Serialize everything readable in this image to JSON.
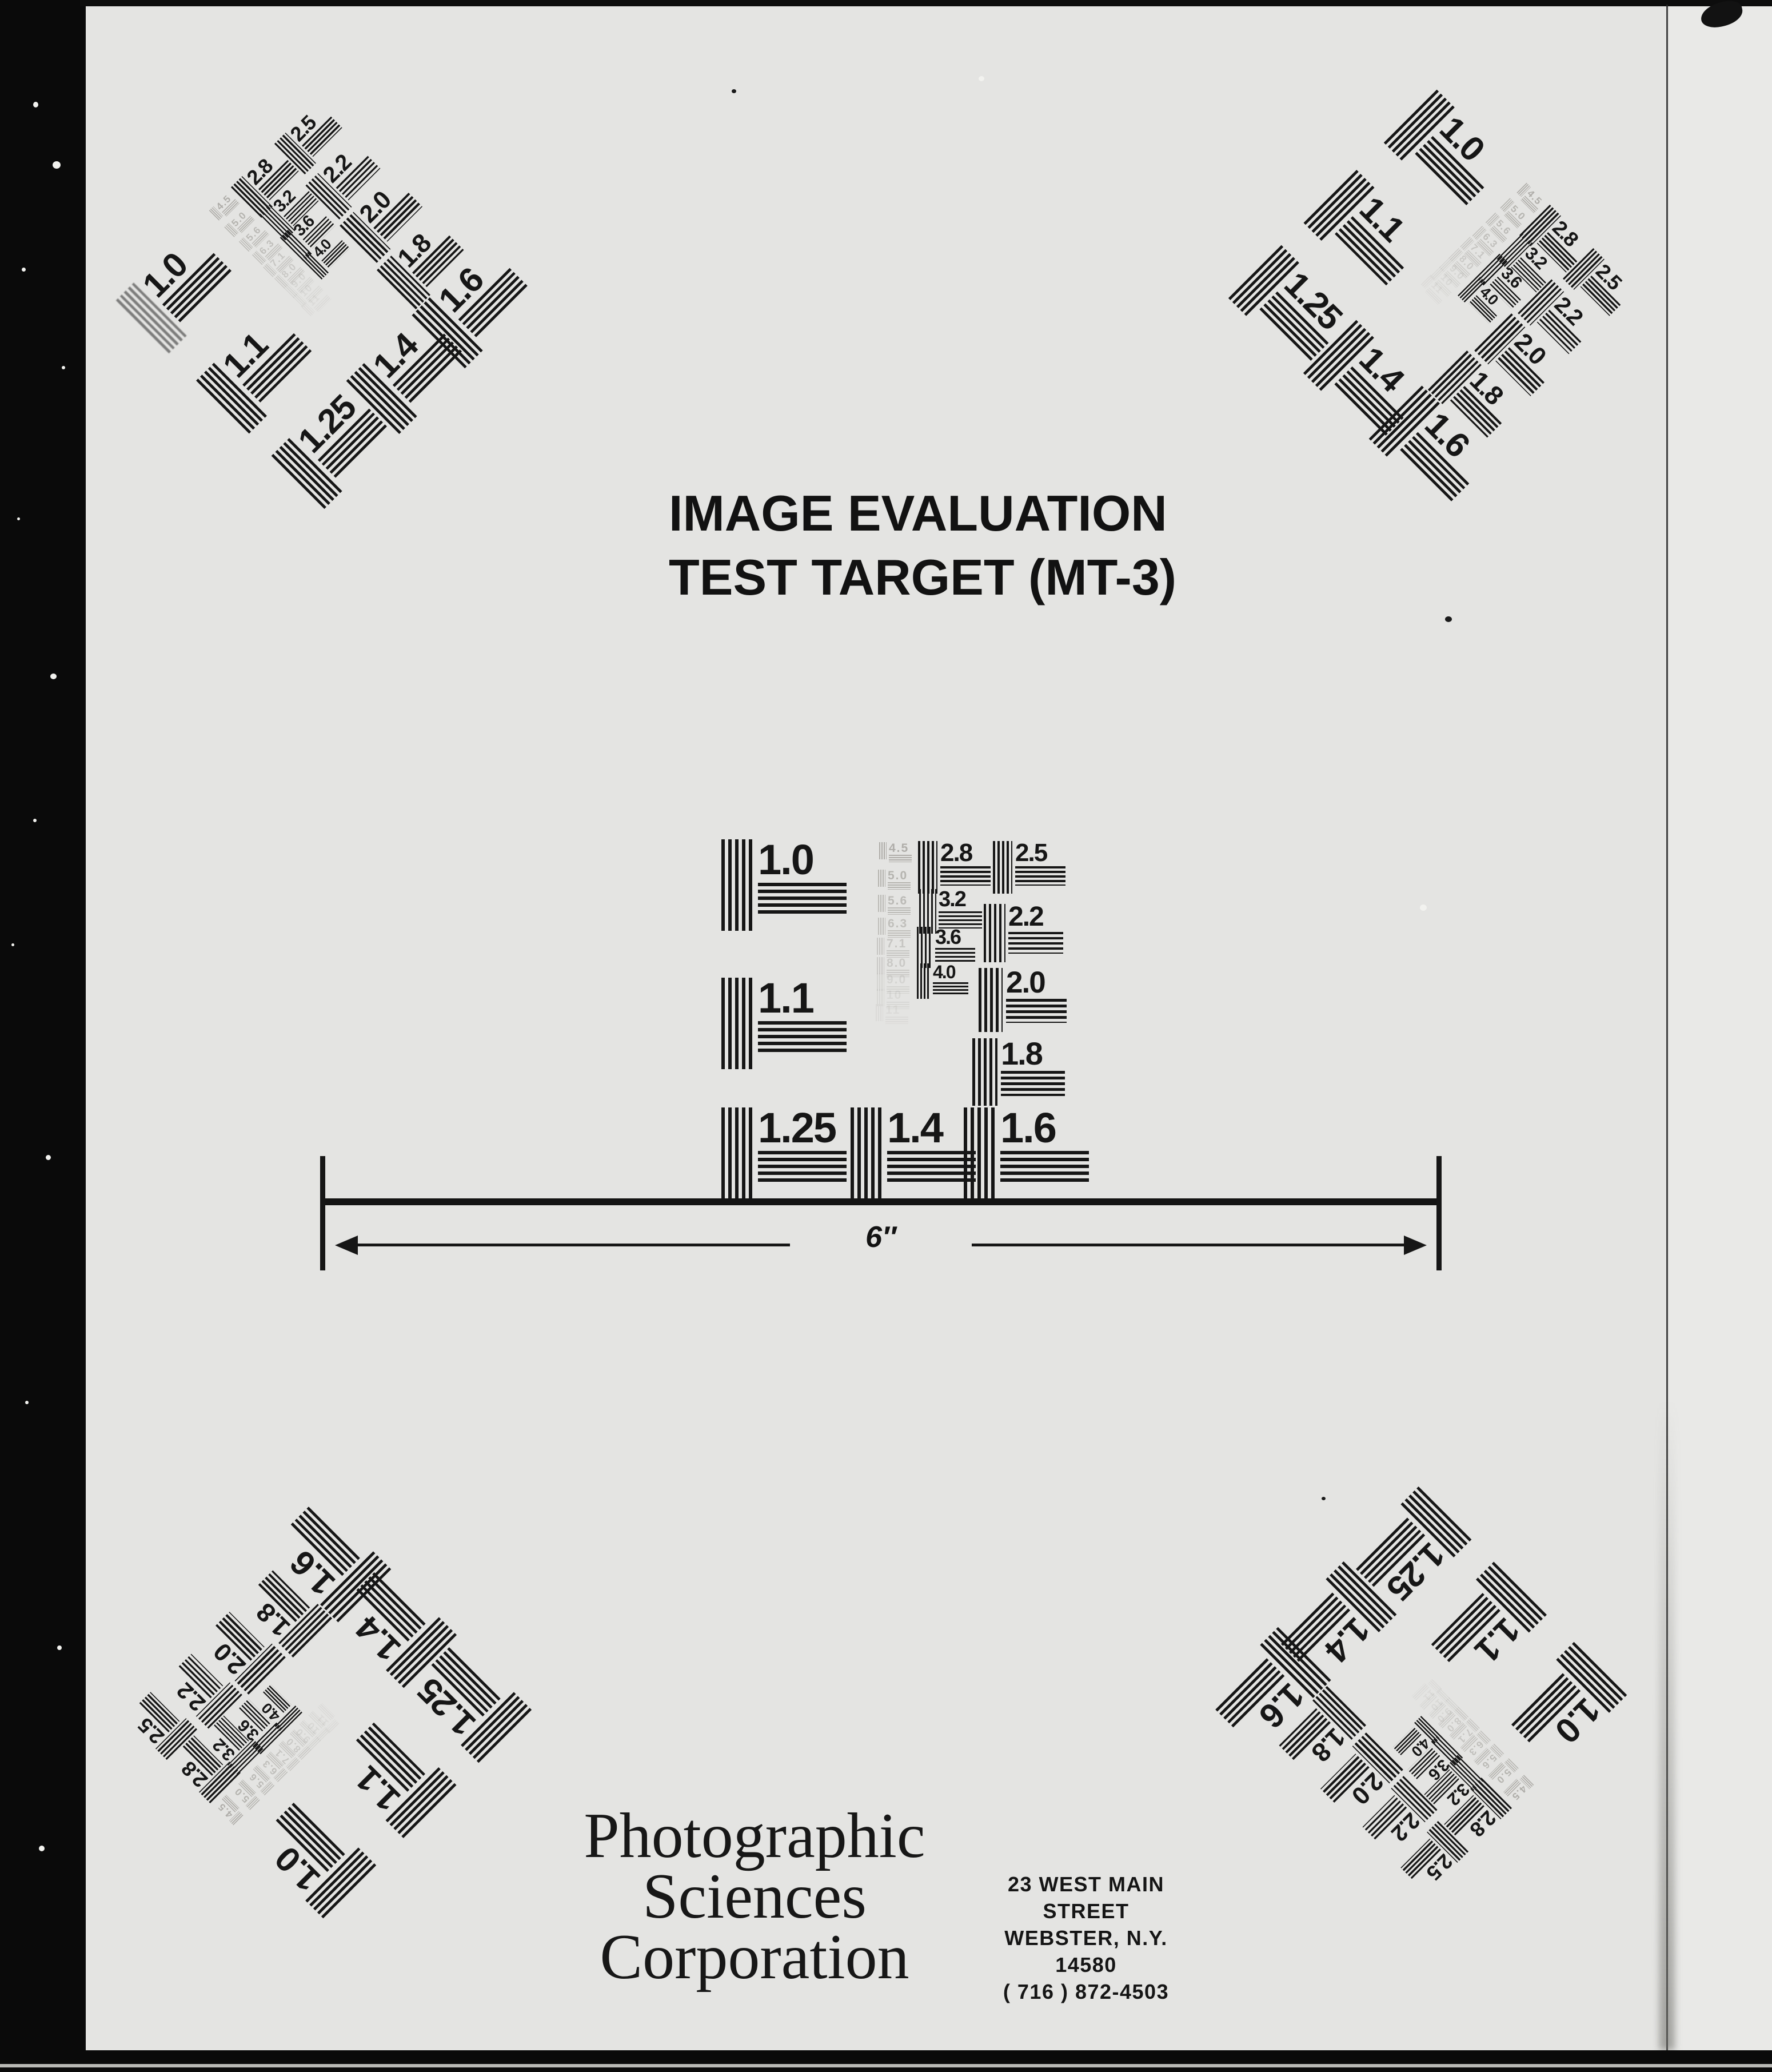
{
  "document": {
    "title_line1": "IMAGE EVALUATION",
    "title_line2": "TEST TARGET (MT-3)"
  },
  "scalebar": {
    "label": "6″"
  },
  "footer": {
    "company": [
      "Photographic",
      "Sciences",
      "Corporation"
    ],
    "address": [
      "23 WEST MAIN STREET",
      "WEBSTER, N.Y. 14580",
      "( 716 ) 872-4503"
    ]
  },
  "pattern": {
    "large": {
      "v10": "1.0",
      "v11": "1.1",
      "v125": "1.25",
      "v14": "1.4",
      "v16": "1.6"
    },
    "mid": {
      "v28": "2.8",
      "v32": "3.2",
      "v36": "3.6",
      "v40": "4.0"
    },
    "right": {
      "v18": "1.8",
      "v20": "2.0",
      "v22": "2.2",
      "v25": "2.5"
    },
    "faint": [
      "4.5",
      "5.0",
      "5.6",
      "6.3",
      "7.1",
      "8.0"
    ],
    "faint_extra": [
      "9.0",
      "10",
      "11"
    ]
  },
  "colors": {
    "film_black": "#0a0a0a",
    "page_gray": "#e4e4e2",
    "ink": "#161616",
    "faint_ink": "#8f8d87"
  }
}
